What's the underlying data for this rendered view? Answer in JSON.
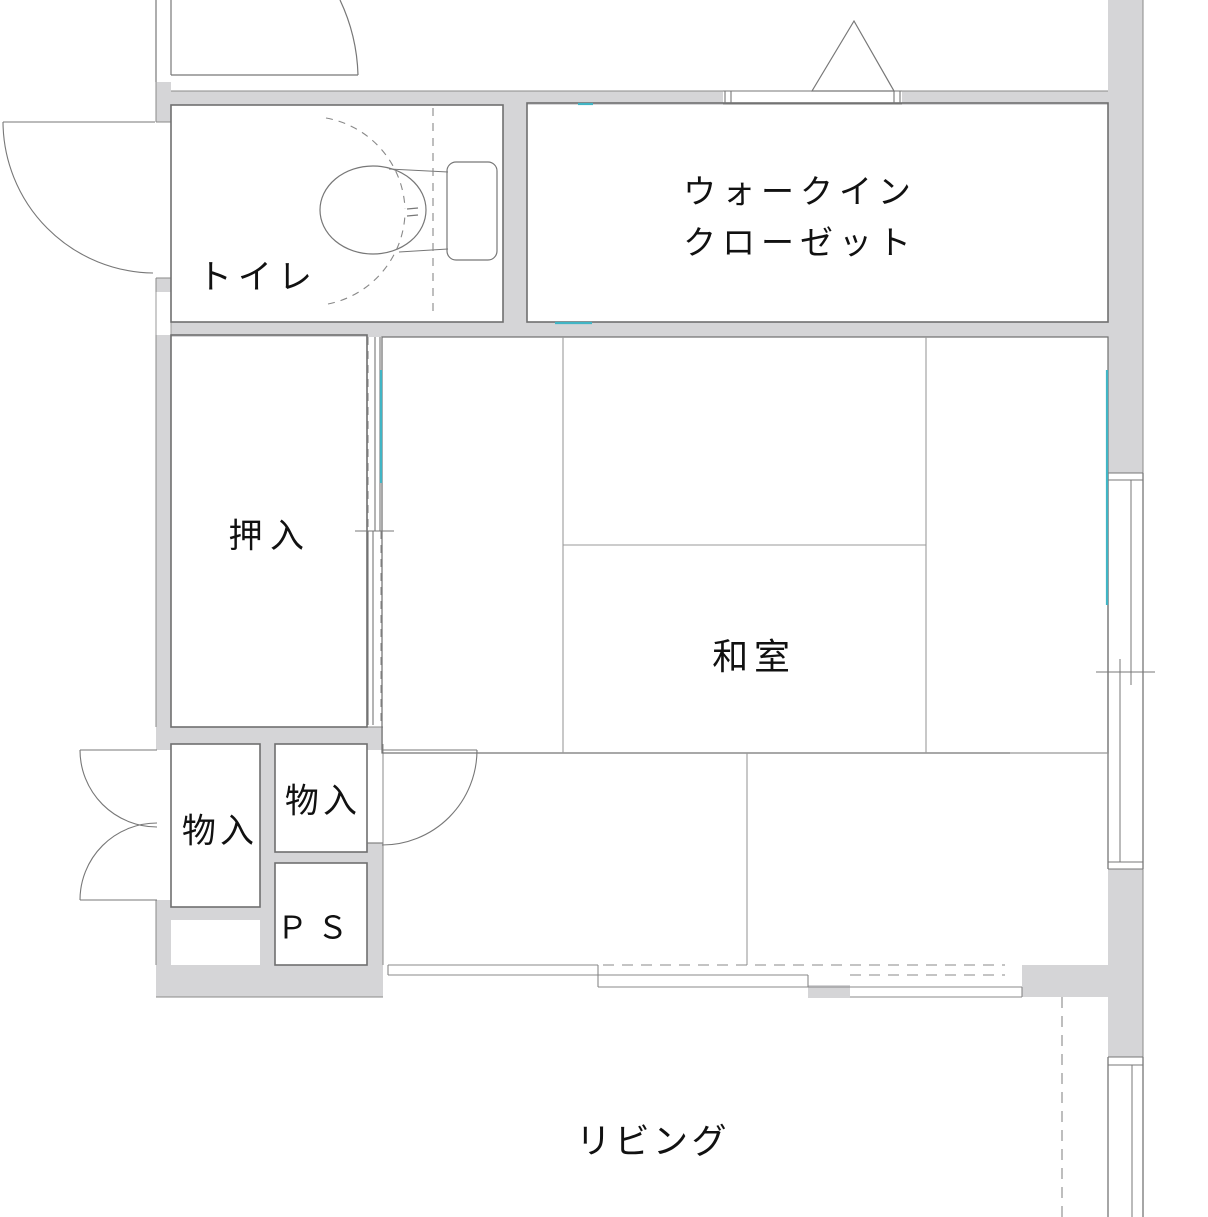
{
  "floorplan": {
    "rooms": {
      "toilet": {
        "label": "トイレ"
      },
      "walk_in_closet": {
        "label_line1": "ウォークイン",
        "label_line2": "クローゼット"
      },
      "oshiire": {
        "label": "押入"
      },
      "washitsu": {
        "label": "和室"
      },
      "storage_left": {
        "label": "物入"
      },
      "storage_upper": {
        "label": "物入"
      },
      "pipe_space": {
        "label": "ＰＳ"
      },
      "living": {
        "label": "リビング"
      }
    },
    "colors": {
      "background": "#ffffff",
      "wall_fill": "#d5d5d7",
      "wall_edge": "#8a8a8a",
      "outline": "#6f6f6f",
      "thin_line": "#777777",
      "tatami_line": "#9a9a9a",
      "dashed_line": "#888888",
      "accent_teal": "#41b5c5",
      "text": "#111111"
    }
  }
}
